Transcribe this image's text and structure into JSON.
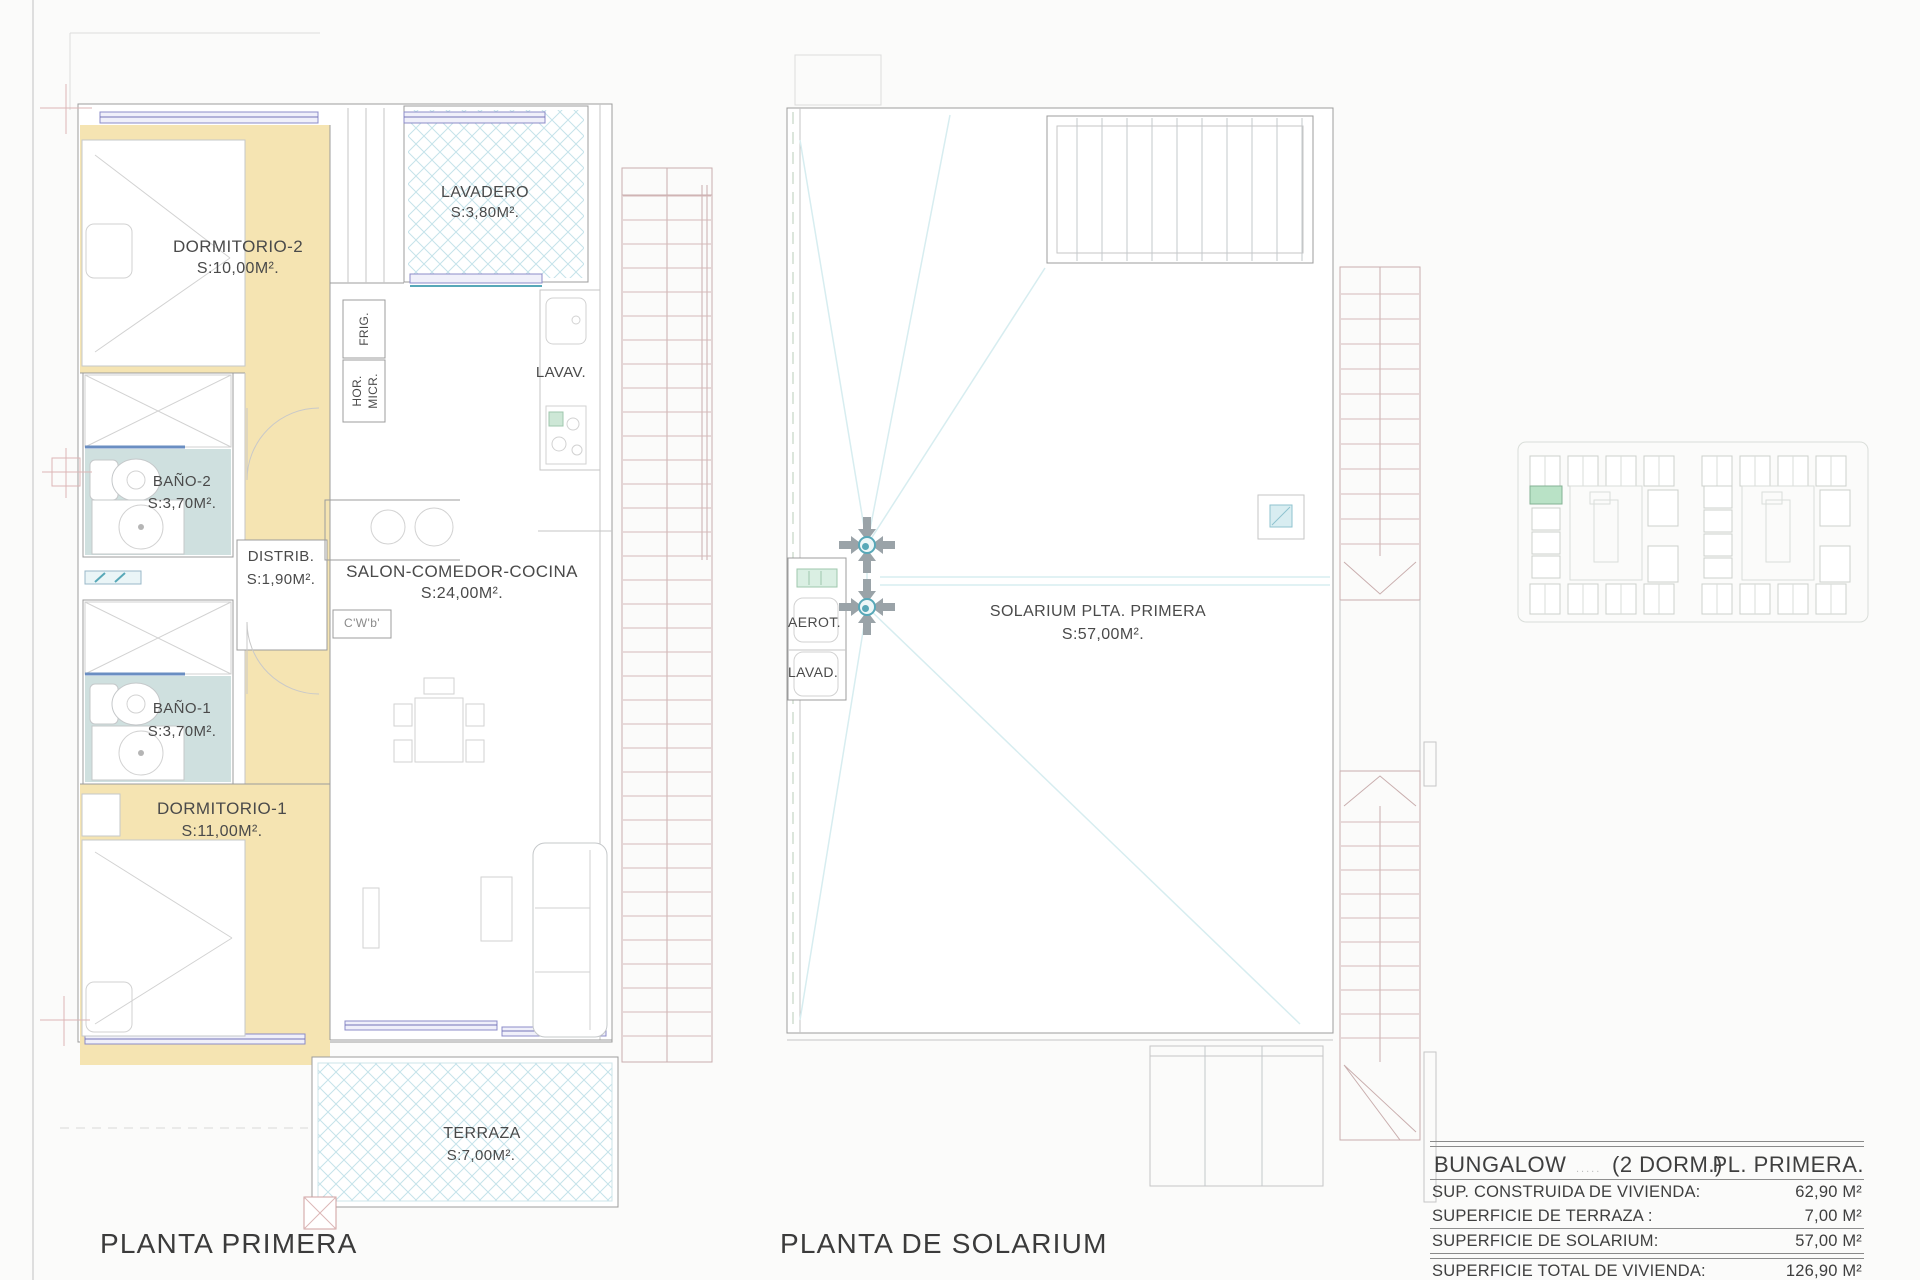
{
  "plan_left": {
    "title": "PLANTA PRIMERA",
    "dormitorio2": {
      "name": "DORMITORIO-2",
      "area": "S:10,00M²."
    },
    "lavadero": {
      "name": "LAVADERO",
      "area": "S:3,80M²."
    },
    "frig": "FRIG.",
    "hor": "HOR.",
    "micr": "MICR.",
    "lavav": "LAVAV.",
    "bano2": {
      "name": "BAÑO-2",
      "area": "S:3,70M²."
    },
    "distrib": {
      "name": "DISTRIB.",
      "area": "S:1,90M²."
    },
    "salon": {
      "name": "SALON-COMEDOR-COCINA",
      "area": "S:24,00M²."
    },
    "cwb": "C'W'b'",
    "bano1": {
      "name": "BAÑO-1",
      "area": "S:3,70M²."
    },
    "dormitorio1": {
      "name": "DORMITORIO-1",
      "area": "S:11,00M²."
    },
    "terraza": {
      "name": "TERRAZA",
      "area": "S:7,00M²."
    }
  },
  "plan_right": {
    "title": "PLANTA DE SOLARIUM",
    "aerot": "AEROT.",
    "lavad": "LAVAD.",
    "solarium": {
      "name": "SOLARIUM PLTA. PRIMERA",
      "area": "S:57,00M²."
    }
  },
  "summary": {
    "product": "BUNGALOW",
    "dots": ".....",
    "type": "(2 DORM.)",
    "floor": "PL. PRIMERA.",
    "rows": [
      {
        "label": "SUP. CONSTRUIDA DE VIVIENDA:",
        "value": "62,90 M²"
      },
      {
        "label": "SUPERFICIE DE TERRAZA :",
        "value": "7,00 M²"
      },
      {
        "label": "SUPERFICIE  DE SOLARIUM:",
        "value": "57,00 M²"
      },
      {
        "label": "SUPERFICIE  TOTAL DE VIVIENDA:",
        "value": "126,90 M²"
      }
    ]
  },
  "colors": {
    "floor_tan": "#f5e4b2",
    "floor_teal": "#cfe0df",
    "hatch_cyan": "#c5e3ea",
    "window_purple": "#8c8cc8",
    "stair_red": "#d6b9b9",
    "slope_cyan": "#d7edf0",
    "drain_teal": "#58a8b8",
    "site_highlight": "#b9e2c6",
    "text": "#4a4a4a"
  }
}
